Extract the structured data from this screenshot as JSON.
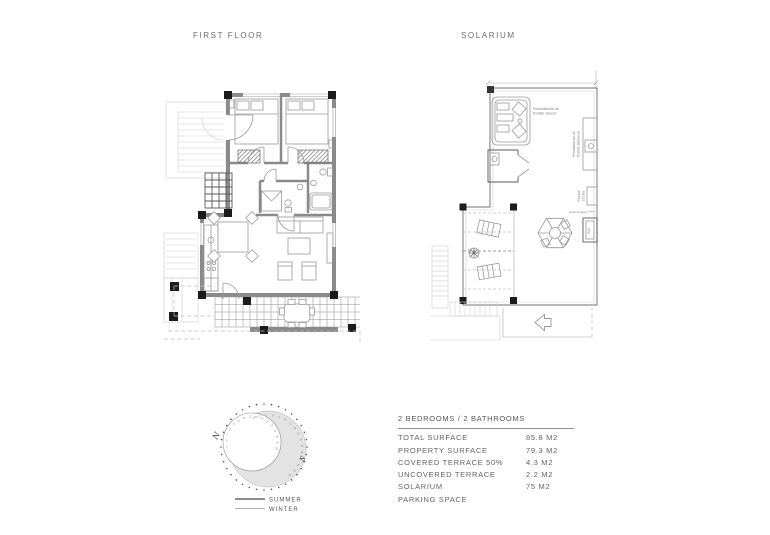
{
  "titles": {
    "first_floor": "FIRST FLOOR",
    "solarium": "SOLARIUM"
  },
  "solarium_labels": {
    "jacuzzi_line1": "Preinstalación de",
    "jacuzzi_line2": "Posible Jacuzzi",
    "barbecue_line1": "Preinstalación de",
    "barbecue_line2": "Posible Barbacoa",
    "kitchen_line1": "Posible",
    "kitchen_line2": "Cocina",
    "water_point": "punto de agua",
    "ac_unit": "A/A"
  },
  "compass": {
    "north": "N",
    "south": "S",
    "hours": [
      "5",
      "6",
      "7",
      "8",
      "9",
      "10",
      "11",
      "12",
      "13",
      "14",
      "15",
      "16",
      "17",
      "18",
      "19",
      "20"
    ],
    "legend": {
      "summer": "SUMMER",
      "winter": "WINTER"
    }
  },
  "spec_table": {
    "header": "2 BEDROOMS / 2 BATHROOMS",
    "rows": [
      {
        "label": "TOTAL SURFACE",
        "value": "85.8 M2"
      },
      {
        "label": "PROPERTY SURFACE",
        "value": "79.3 M2"
      },
      {
        "label": "COVERED TERRACE 50%",
        "value": "4.3 M2"
      },
      {
        "label": "UNCOVERED TERRACE",
        "value": "2.2 M2"
      },
      {
        "label": "SOLARIUM",
        "value": "75 M2"
      },
      {
        "label": "PARKING SPACE",
        "value": ""
      }
    ]
  },
  "colors": {
    "wall": "#8a8a8a",
    "column": "#1b1b1b",
    "light_line": "#d0d0d0",
    "sun_shade": "#e3e3e3",
    "text": "#636363"
  }
}
